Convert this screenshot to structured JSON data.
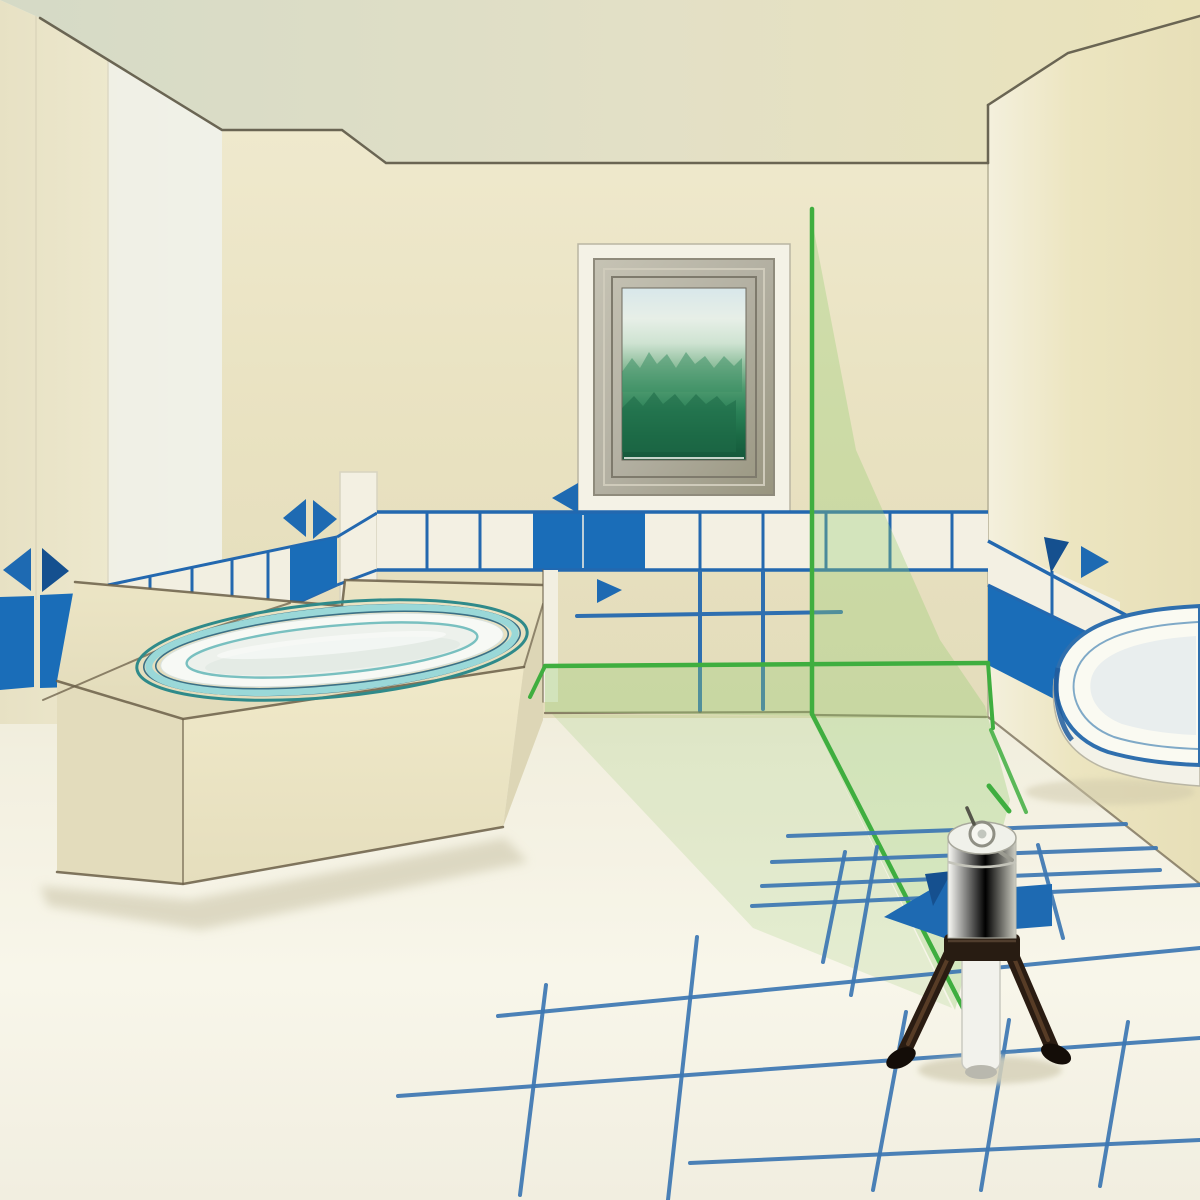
{
  "meta": {
    "kind": "instructional illustration",
    "subject": "bathroom being tiled with help of a cross-line laser level on a mini tripod",
    "canvas": {
      "width": 1200,
      "height": 1200
    }
  },
  "palette": {
    "laser_green": "#3fae3f",
    "laser_tint_strong": "rgba(150,205,115,0.34)",
    "laser_tint_soft": "rgba(150,200,110,0.20)",
    "tile_blue": "#1a6db8",
    "tile_outline": "#2368af",
    "grid_blue": "#3d77b3",
    "marker_blue": "#1e6ab2",
    "marker_navy": "#15508f",
    "sketch_line": "#6b5f48",
    "ceiling_edge": "#6a6553",
    "wall_cream": "#e9e2c1",
    "wall_left_pale": "#eff1e8",
    "ceiling_left": "#d5dac6",
    "ceiling_right": "#eae3ba",
    "floor_light": "#f8f6ea",
    "tub_cyan": "#9ad8d8",
    "tub_teal": "#2f8a8a",
    "tub_rim_white": "#f7f9f5",
    "tub_basin": "#edf1ec",
    "frame_grey": "#b3b0a2",
    "frame_white": "#f4f2e6",
    "picture_sky": "#d8e7ea",
    "picture_green": "#4f9b70",
    "picture_dark_green": "#14573a",
    "device_white": "#f0f1ea",
    "clamp_dark": "#281c12",
    "tripod_dark": "#2a1c12",
    "shadow": "#d7d2ba"
  },
  "objects": {
    "window_picture": "view of green treetops through a small framed window",
    "bathtub": "oval built-in bathtub on a beige platform with cyan rim",
    "wash_basin": "white wash basin at right wall",
    "laser_device": "white cylindrical cross-line laser on short dark tripod",
    "laser_lines": [
      "vertical line on back wall",
      "horizontal line above wall base",
      "line across floor to device"
    ],
    "tile_borders": "blue and white tile border rows on walls",
    "floor_grid": "blue tile layout grid drawn on floor",
    "alignment_markers_count": 8
  }
}
